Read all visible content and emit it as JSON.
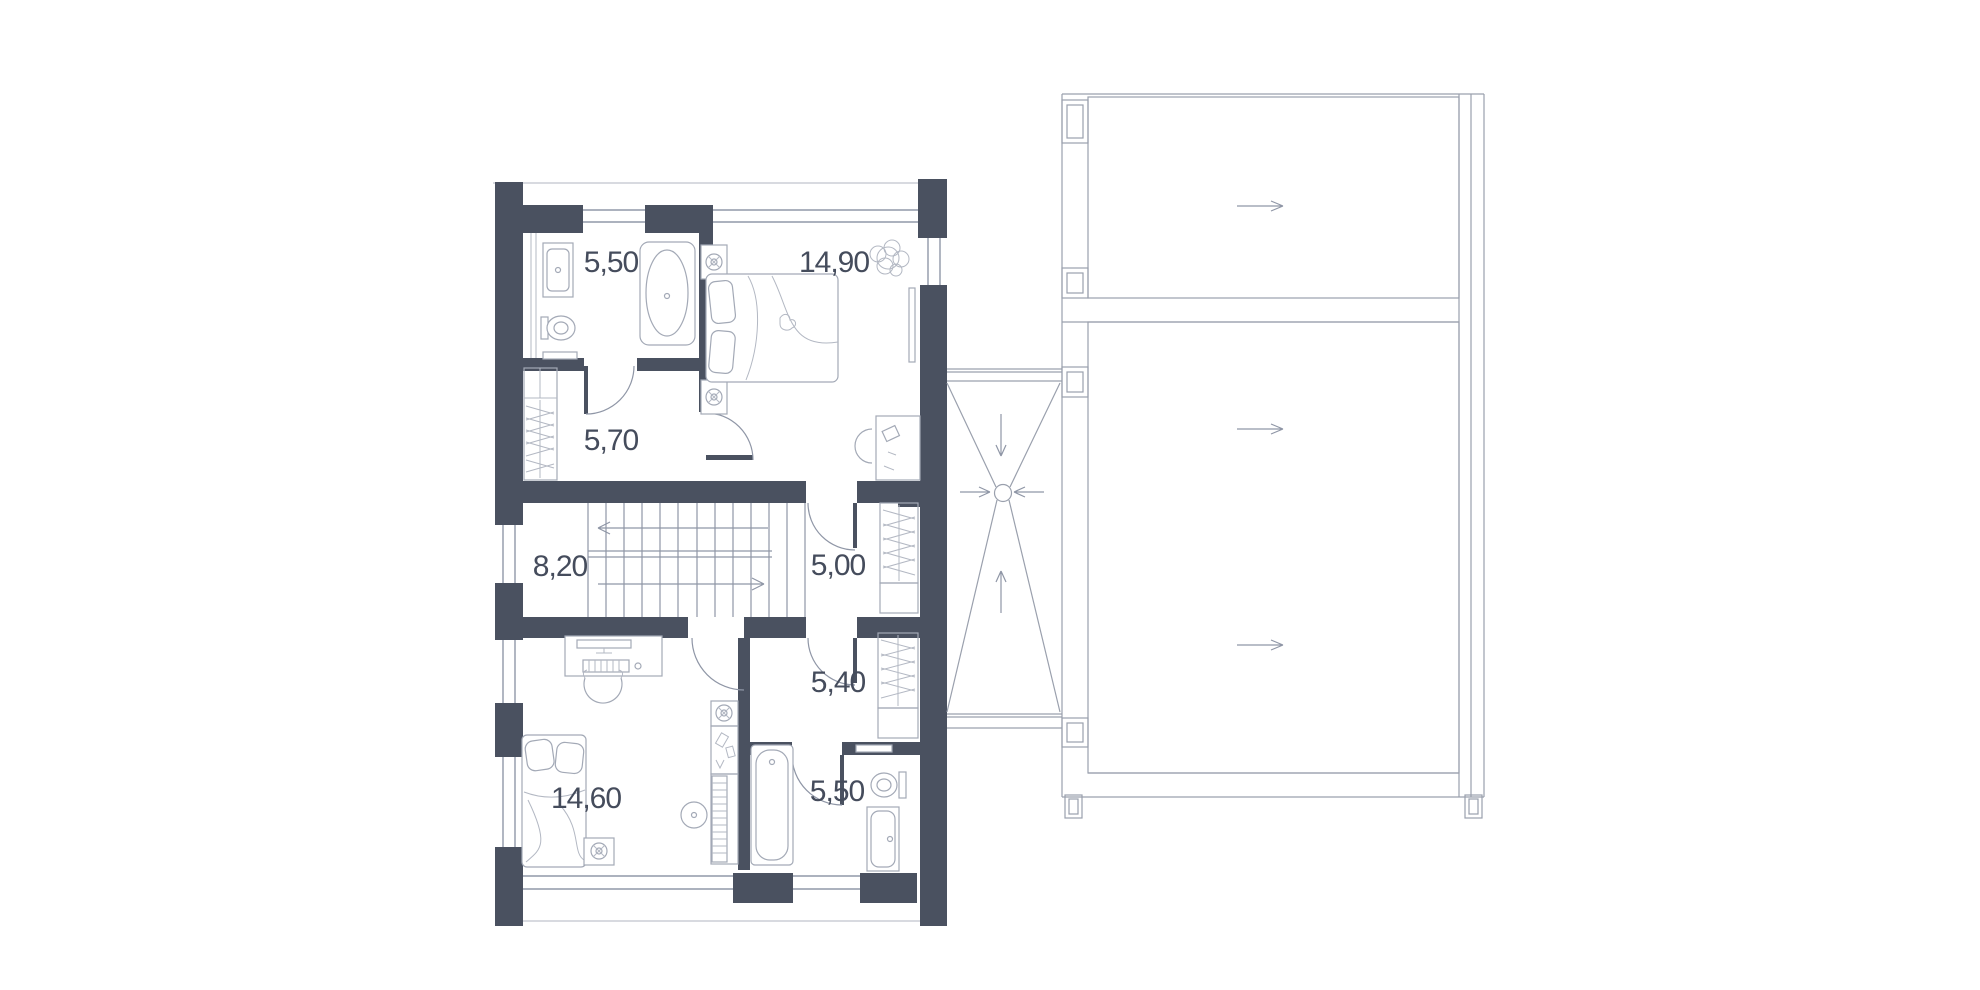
{
  "plan": {
    "type": "floor-plan-second-storey",
    "rooms": [
      {
        "id": "bathroom-upper",
        "area": "5,50"
      },
      {
        "id": "bedroom-upper",
        "area": "14,90"
      },
      {
        "id": "hall-upper",
        "area": "5,70"
      },
      {
        "id": "staircase",
        "area": "8,20"
      },
      {
        "id": "walk-in-closet",
        "area": "5,00"
      },
      {
        "id": "hall-lower",
        "area": "5,40"
      },
      {
        "id": "bedroom-lower",
        "area": "14,60"
      },
      {
        "id": "bathroom-lower",
        "area": "5,50"
      }
    ],
    "colors": {
      "wall": "#4a5160",
      "line": "#9098a8",
      "furniture": "#a3a9b6",
      "text": "#454c5c",
      "background": "#ffffff"
    },
    "roof_plan": {
      "slope_arrows": [
        "right",
        "right",
        "right"
      ],
      "flat_roof_drain": {
        "arrows_to_drain": [
          "down",
          "right",
          "left",
          "up"
        ]
      }
    }
  }
}
